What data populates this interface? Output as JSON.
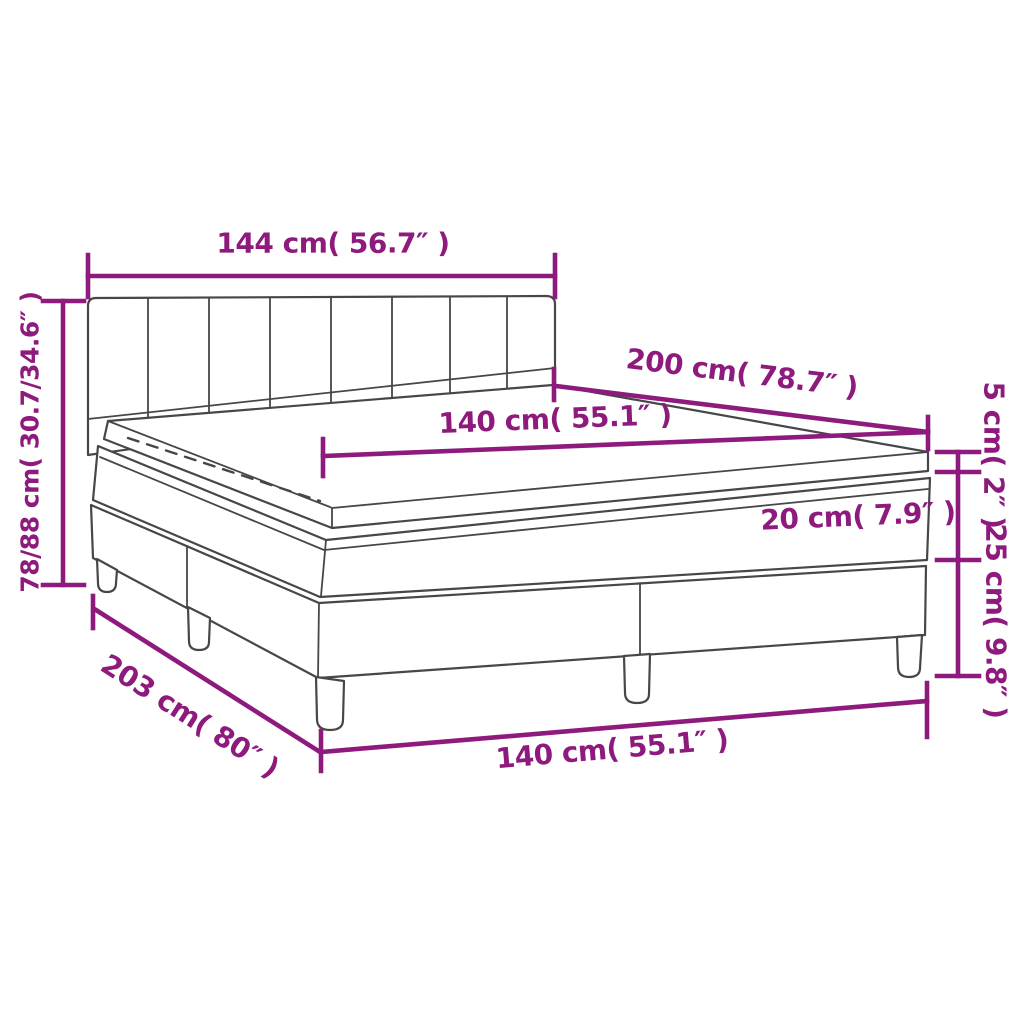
{
  "diagram": {
    "type": "product-dimension-diagram",
    "subject": "box-spring-bed-with-mattress-and-topper",
    "colors": {
      "dimension": "#8D1A7C",
      "lineart": "#474747",
      "background": "#FFFFFF"
    },
    "dimensions": {
      "headboard_width": {
        "cm": "144",
        "inch": "56.7",
        "label": "144 cm( 56.7″ )"
      },
      "total_height": {
        "cm": "78/88",
        "inch": "30.7/34.6",
        "label": "78/88 cm( 30.7/34.6″ )"
      },
      "bed_length": {
        "cm": "200",
        "inch": "78.7",
        "label": "200 cm( 78.7″ )"
      },
      "mattress_width_top": {
        "cm": "140",
        "inch": "55.1",
        "label": "140 cm( 55.1″ )"
      },
      "topper_height": {
        "cm": "5",
        "inch": "2",
        "label": "5 cm( 2″ )"
      },
      "mattress_height": {
        "cm": "20",
        "inch": "7.9",
        "label": "20 cm( 7.9″ )"
      },
      "base_height": {
        "cm": "25",
        "inch": "9.8",
        "label": "25 cm( 9.8″ )"
      },
      "frame_length": {
        "cm": "203",
        "inch": "80",
        "label": "203 cm( 80″ )"
      },
      "frame_width_bottom": {
        "cm": "140",
        "inch": "55.1",
        "label": "140 cm( 55.1″ )"
      }
    },
    "parts": {
      "headboard": "tufted headboard, 8 columns x 2 rows",
      "topper": "mattress topper with zipper stitching",
      "mattress": "pocket spring mattress",
      "base": "two-piece box spring base",
      "legs": "5 visible legs"
    }
  }
}
